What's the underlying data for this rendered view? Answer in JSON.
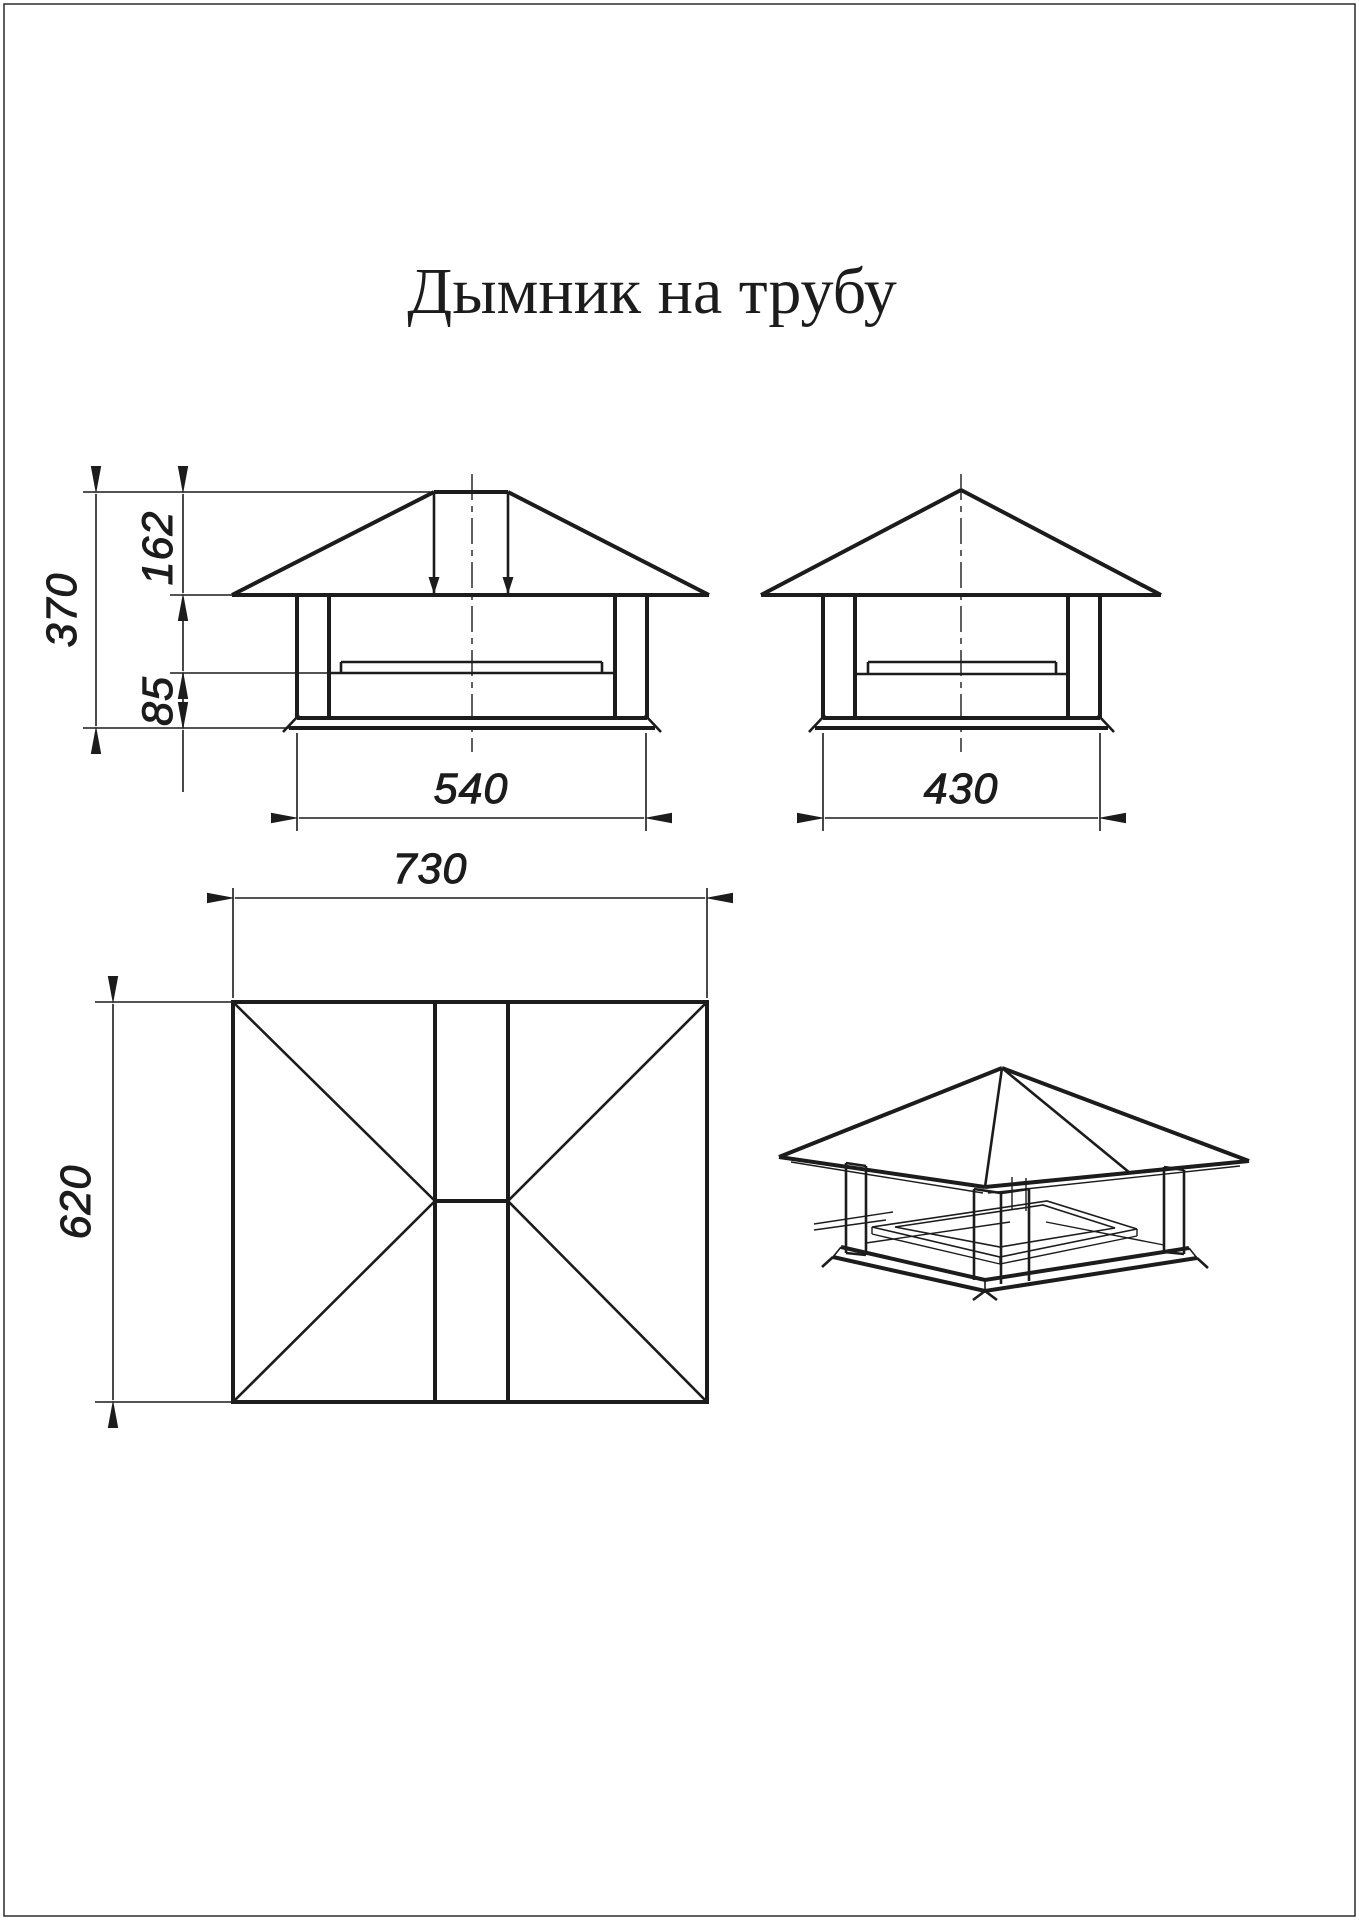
{
  "title": "Дымник на трубу",
  "colors": {
    "ink": "#1c1c1c",
    "paper": "#ffffff"
  },
  "dimensions": {
    "front": {
      "total_height": "370",
      "roof_height": "162",
      "body_height": "85",
      "width": "540"
    },
    "side": {
      "width": "430"
    },
    "plan": {
      "width": "730",
      "depth": "620"
    }
  }
}
